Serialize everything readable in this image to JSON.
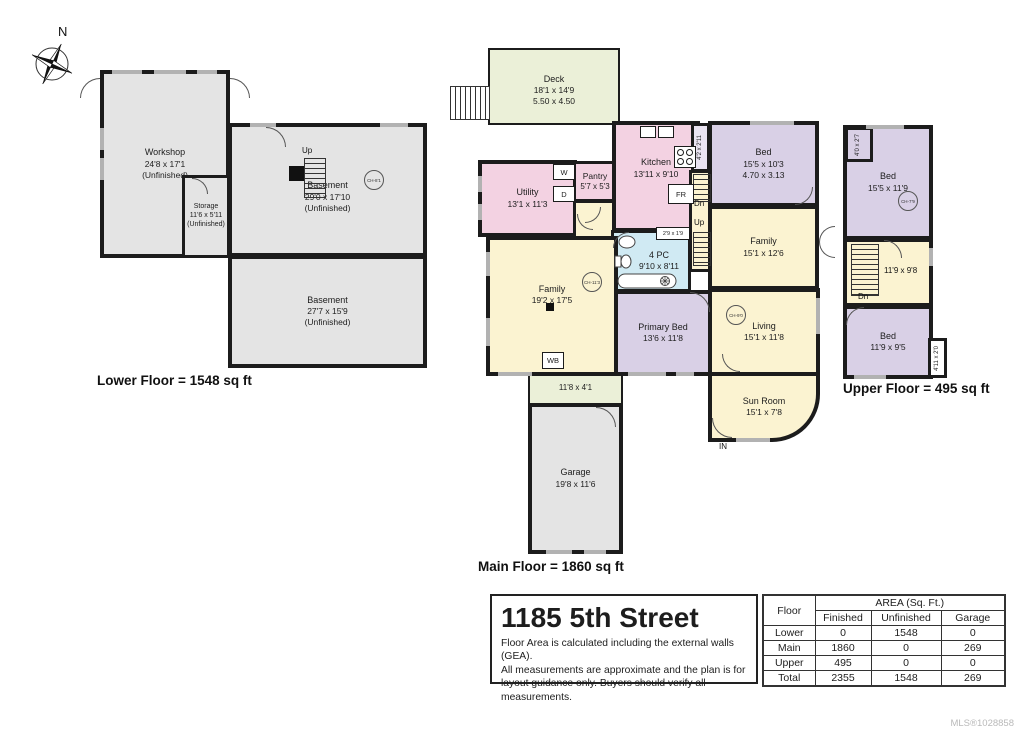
{
  "compass": {
    "north": "N"
  },
  "floors": {
    "lower": {
      "label": "Lower Floor = 1548 sq ft",
      "rooms": {
        "workshop": {
          "name": "Workshop",
          "dims": "24'8 x 17'1",
          "note": "(Unfinished)"
        },
        "storage": {
          "name": "Storage",
          "dims": "11'6 x 5'11",
          "note": "(Unfinished)"
        },
        "basement_upper": {
          "name": "Basement",
          "dims": "29'0 x 17'10",
          "note": "(Unfinished)",
          "stair_label": "Up",
          "ceiling_height": "CH-8'1"
        },
        "basement_lower": {
          "name": "Basement",
          "dims": "27'7 x 15'9",
          "note": "(Unfinished)"
        }
      }
    },
    "main": {
      "label": "Main Floor = 1860 sq ft",
      "rooms": {
        "deck": {
          "name": "Deck",
          "dims": "18'1 x 14'9",
          "metric": "5.50 x 4.50"
        },
        "utility": {
          "name": "Utility",
          "dims": "13'1 x 11'3"
        },
        "pantry": {
          "name": "Pantry",
          "dims": "5'7 x 5'3"
        },
        "washer": "W",
        "dryer": "D",
        "kitchen": {
          "name": "Kitchen",
          "dims": "13'11 x 9'10"
        },
        "fridge": "FR",
        "hall_closet": "4'2 x 2'11",
        "bed": {
          "name": "Bed",
          "dims": "15'5 x 10'3",
          "metric": "4.70 x 3.13"
        },
        "family_rear": {
          "name": "Family",
          "dims": "15'1 x 12'6"
        },
        "stairs_down": "Dn",
        "stairs_up": "Up",
        "bath": {
          "name": "4 PC",
          "dims": "9'10 x 8'11",
          "closet": "2'9 x 1'9"
        },
        "family_front": {
          "name": "Family",
          "dims": "19'2 x 17'5",
          "ceiling_height": "CH-11'3"
        },
        "wood_burner": "WB",
        "primary_bed": {
          "name": "Primary Bed",
          "dims": "13'6 x 11'8"
        },
        "living": {
          "name": "Living",
          "dims": "15'1 x 11'8",
          "ceiling_height": "CH-9'0"
        },
        "sun_room": {
          "name": "Sun Room",
          "dims": "15'1 x 7'8"
        },
        "entry": "IN",
        "walkway": "11'8 x 4'1",
        "garage": {
          "name": "Garage",
          "dims": "19'8 x 11'6"
        }
      }
    },
    "upper": {
      "label": "Upper Floor = 495 sq ft",
      "rooms": {
        "closet_front": "4'0 x 2'7",
        "bed_front": {
          "name": "Bed",
          "dims": "15'5 x 11'9",
          "ceiling_height": "CH-7'9"
        },
        "landing": {
          "dims": "11'9 x 9'8",
          "stair_label": "Dn"
        },
        "bed_rear": {
          "name": "Bed",
          "dims": "11'9 x 9'5"
        },
        "closet_rear": "4'11 x 2'0"
      }
    }
  },
  "title_block": {
    "address": "1185 5th Street",
    "disclaimer": [
      "Floor Area is calculated including the external walls (GEA).",
      "All measurements are approximate and the plan is for",
      "layout guidance only. Buyers should verify all measurements."
    ]
  },
  "area_table": {
    "floor_header": "Floor",
    "area_header": "AREA (Sq. Ft.)",
    "columns": [
      "Finished",
      "Unfinished",
      "Garage"
    ],
    "rows": [
      {
        "floor": "Lower",
        "finished": "0",
        "unfinished": "1548",
        "garage": "0"
      },
      {
        "floor": "Main",
        "finished": "1860",
        "unfinished": "0",
        "garage": "269"
      },
      {
        "floor": "Upper",
        "finished": "495",
        "unfinished": "0",
        "garage": "0"
      },
      {
        "floor": "Total",
        "finished": "2355",
        "unfinished": "1548",
        "garage": "269"
      }
    ]
  },
  "footer": {
    "mls": "MLS®1028858"
  },
  "colors": {
    "wall": "#1c1c1c",
    "unfinished_gray": "#e4e4e4",
    "finished_yellow": "#fbf3d1",
    "bedroom_purple": "#d9d0e6",
    "kitchen_pink": "#f3d2e2",
    "bath_blue": "#d0eaf3",
    "deck_green": "#ebf0d8",
    "window_gray": "#b2b2b2"
  }
}
